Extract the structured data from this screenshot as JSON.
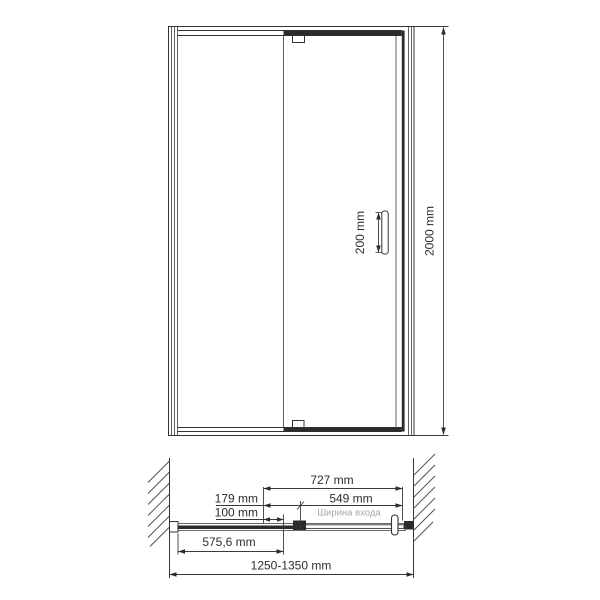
{
  "drawing": {
    "description": "Shower door technical drawing, front elevation and top plan view",
    "front_view": {
      "height_dim": "2000 mm",
      "handle_dim": "200 mm"
    },
    "plan_view": {
      "door_total_dim": "727 mm",
      "pivot_offset_dim": "179 mm",
      "entrance_dim": "549 mm",
      "overlap_dim": "100 mm",
      "entrance_caption": "Ширина входа",
      "fixed_glass_dim": "575,6 mm",
      "adjustment_range_dim": "1250-1350 mm"
    },
    "colors": {
      "line": "#333333",
      "solid": "#2b2b2b",
      "muted_text": "#a6a6a6",
      "background": "#ffffff"
    }
  }
}
